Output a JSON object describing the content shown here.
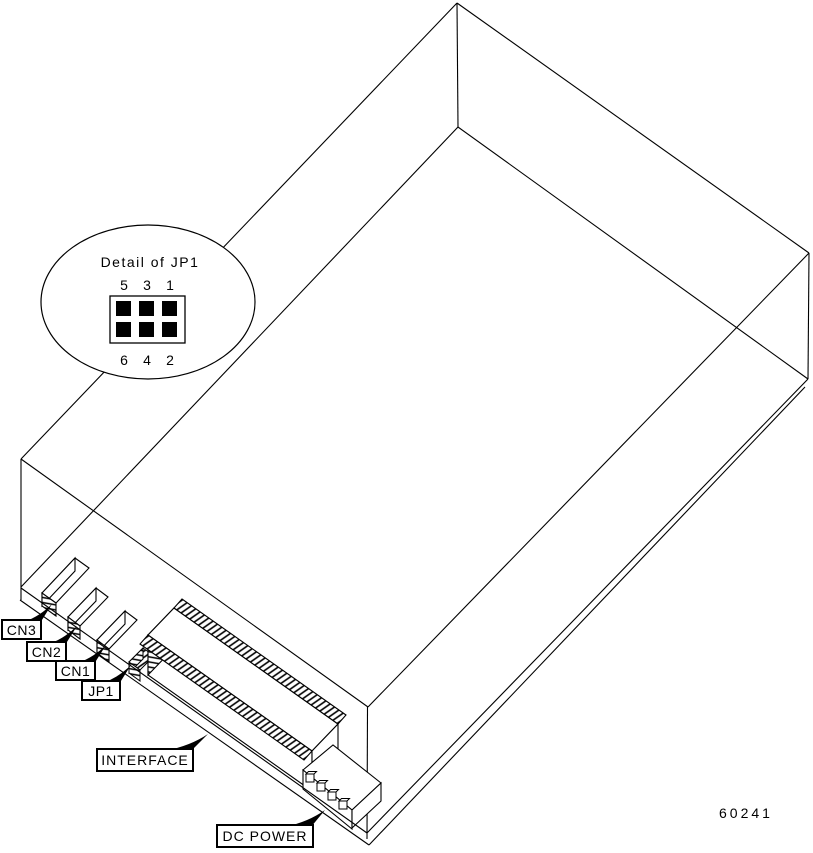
{
  "figure": {
    "number": "60241",
    "detail": {
      "title": "Detail of JP1",
      "pins_top": [
        "5",
        "3",
        "1"
      ],
      "pins_bottom": [
        "6",
        "4",
        "2"
      ]
    },
    "callouts": {
      "cn3": "CN3",
      "cn2": "CN2",
      "cn1": "CN1",
      "jp1": "JP1",
      "interface": "INTERFACE",
      "dc_power": "DC POWER"
    },
    "colors": {
      "line": "#000000",
      "background": "#ffffff"
    }
  }
}
